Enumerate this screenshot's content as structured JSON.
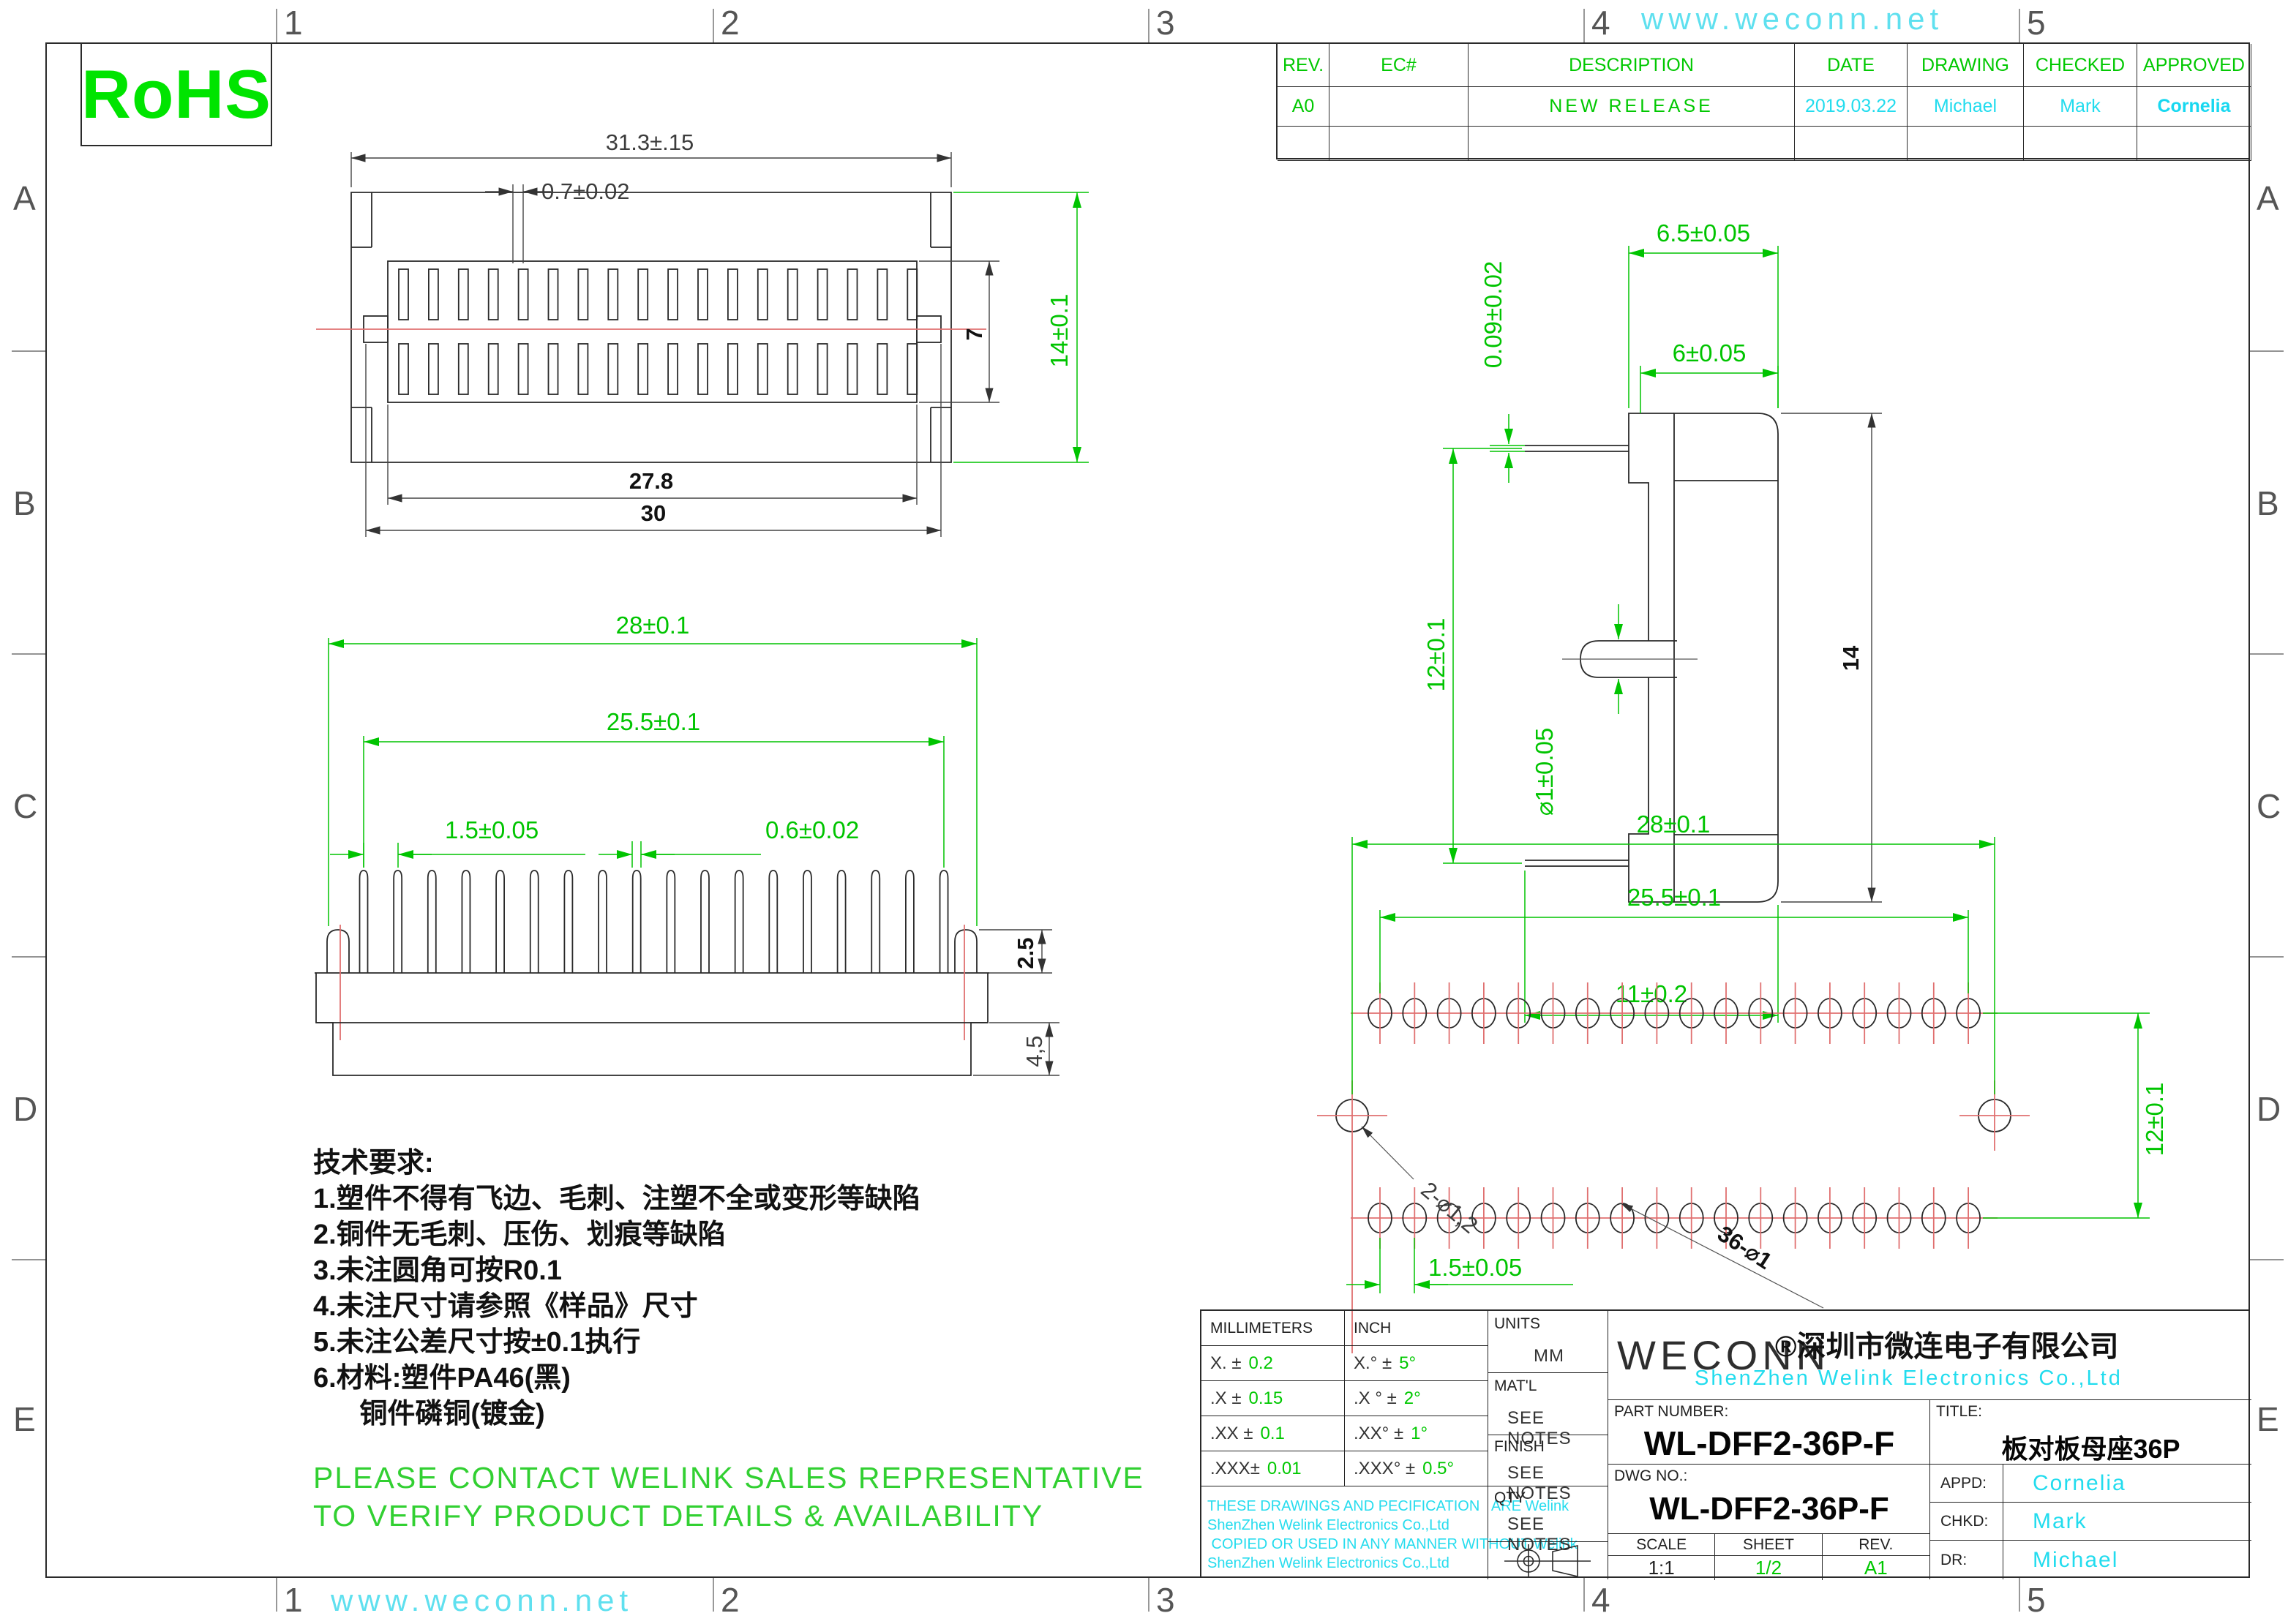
{
  "border": {
    "numbers": [
      "1",
      "2",
      "3",
      "4",
      "5"
    ],
    "letters": [
      "A",
      "B",
      "C",
      "D",
      "E"
    ]
  },
  "watermark": "www.weconn.net",
  "rohs": "RoHS",
  "revision_table": {
    "headers": [
      "REV.",
      "EC#",
      "DESCRIPTION",
      "DATE",
      "DRAWING",
      "CHECKED",
      "APPROVED"
    ],
    "rows": [
      {
        "rev": "A0",
        "ec": "",
        "description": "NEW RELEASE",
        "date": "2019.03.22",
        "drawing": "Michael",
        "checked": "Mark",
        "approved": "Cornelia"
      },
      {
        "rev": "",
        "ec": "",
        "description": "",
        "date": "",
        "drawing": "",
        "checked": "",
        "approved": ""
      }
    ]
  },
  "tech_requirements": {
    "title": "技术要求:",
    "items": [
      "1.塑件不得有飞边、毛刺、注塑不全或变形等缺陷",
      "2.铜件无毛刺、压伤、划痕等缺陷",
      "3.未注圆角可按R0.1",
      "4.未注尺寸请参照《样品》尺寸",
      "5.未注公差尺寸按±0.1执行",
      "6.材料:塑件PA46(黑)",
      "      铜件磷铜(镀金)"
    ]
  },
  "notice": [
    "PLEASE CONTACT WELINK SALES REPRESENTATIVE",
    "TO VERIFY PRODUCT DETAILS & AVAILABILITY"
  ],
  "views": {
    "top_view": {
      "slot_count": 18,
      "dims": {
        "width": "31.3±.15",
        "slot": "0.7±0.02",
        "rows": "7",
        "height": "14±0.1",
        "inner": "27.8",
        "outer": "30"
      }
    },
    "front_view": {
      "pin_count": 18,
      "dims": {
        "w1": "28±0.1",
        "w2": "25.5±0.1",
        "pitch": "1.5±0.05",
        "pin": "0.6±0.02",
        "ear": "2.5",
        "body": "4,5"
      }
    },
    "side_view": {
      "dims": {
        "t": "0.09±0.02",
        "w1": "6.5±0.05",
        "w2": "6±0.05",
        "h": "12±0.1",
        "pin_d": "⌀1±0.05",
        "total": "14",
        "bottom": "11±0.2"
      }
    },
    "footprint": {
      "hole_count": 18,
      "dims": {
        "w1": "28±0.1",
        "w2": "25.5±0.1",
        "h": "12±0.1",
        "pitch": "1.5±0.05"
      },
      "labels": {
        "holes2": "2-⌀1,2",
        "holes36": "36-⌀1"
      }
    }
  },
  "title_block": {
    "tolerance": {
      "col1": "MILLIMETERS",
      "col2": "INCH",
      "rows": [
        {
          "mm_l": "X.  ±",
          "mm_v": "0.2",
          "in_l": "X.°  ±",
          "in_v": "5°"
        },
        {
          "mm_l": ".X  ±",
          "mm_v": "0.15",
          "in_l": ".X °  ±",
          "in_v": "2°"
        },
        {
          "mm_l": ".XX ±",
          "mm_v": "0.1",
          "in_l": ".XX°  ±",
          "in_v": "1°"
        },
        {
          "mm_l": ".XXX±",
          "mm_v": "0.01",
          "in_l": ".XXX° ±",
          "in_v": "0.5°"
        }
      ]
    },
    "units": {
      "label": "UNITS",
      "value": "MM"
    },
    "matl": {
      "label": "MAT'L",
      "value": "SEE NOTES"
    },
    "finish": {
      "label": "FINISH",
      "value": "SEE NOTES"
    },
    "qty": {
      "label": "QTY",
      "value": "SEE NOTES"
    },
    "brand": {
      "logo": "WECONN",
      "company_cn": "®深圳市微连电子有限公司",
      "company_en": "ShenZhen  Welink  Electronics  Co.,Ltd"
    },
    "part_number": {
      "label": "PART NUMBER:",
      "value": "WL-DFF2-36P-F"
    },
    "title": {
      "label": "TITLE:",
      "value": "板对板母座36P"
    },
    "dwg_no": {
      "label": "DWG NO.:",
      "value": "WL-DFF2-36P-F"
    },
    "scale": {
      "label": "SCALE",
      "value": "1:1"
    },
    "sheet": {
      "label": "SHEET",
      "value": "1/2"
    },
    "rev": {
      "label": "REV.",
      "value": "A1"
    },
    "appd": {
      "label": "APPD:",
      "value": "Cornelia"
    },
    "chkd": {
      "label": "CHKD:",
      "value": "Mark"
    },
    "dr": {
      "label": "DR:",
      "value": "Michael"
    },
    "disclaimer": [
      "THESE DRAWINGS AND PECIFICATION   ARE Welink",
      "ShenZhen Welink Electronics Co.,Ltd",
      " COPIED OR USED IN ANY MANNER WITHOUT Welink",
      "ShenZhen Welink Electronics Co.,Ltd"
    ]
  }
}
